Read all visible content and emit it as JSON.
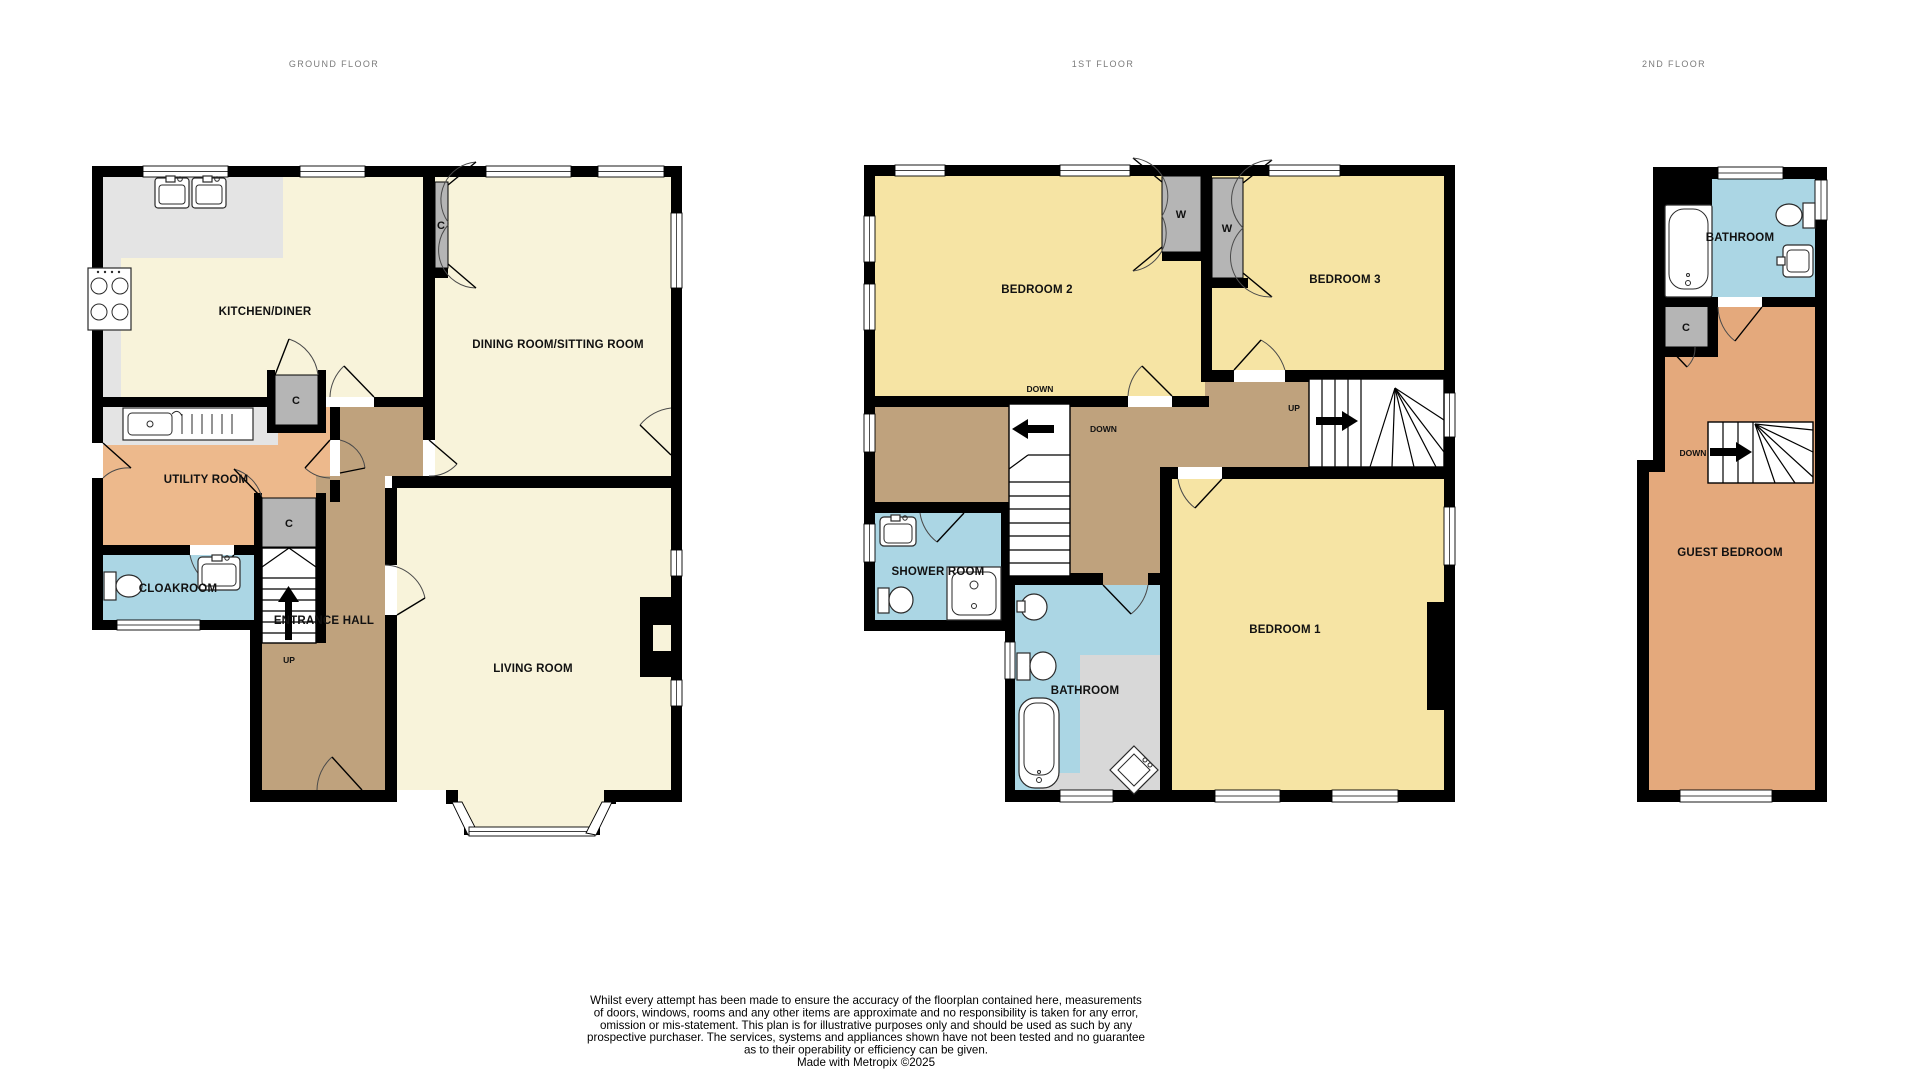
{
  "floors": {
    "ground": {
      "title": "GROUND FLOOR"
    },
    "first": {
      "title": "1ST FLOOR"
    },
    "second": {
      "title": "2ND FLOOR"
    }
  },
  "rooms": {
    "kitchen": "KITCHEN/DINER",
    "dining": "DINING ROOM/SITTING ROOM",
    "utility": "UTILITY ROOM",
    "cloakroom": "CLOAKROOM",
    "hall": "ENTRANCE HALL",
    "living": "LIVING ROOM",
    "bed1": "BEDROOM 1",
    "bed2": "BEDROOM 2",
    "bed3": "BEDROOM 3",
    "shower": "SHOWER ROOM",
    "bathroom_first": "BATHROOM",
    "bathroom_second": "BATHROOM",
    "guest": "GUEST BEDROOM"
  },
  "markers": {
    "cupboard": "C",
    "wardrobe": "W",
    "up": "UP",
    "down": "DOWN"
  },
  "disclaimer": {
    "lines": [
      "Whilst every attempt has been made to ensure the accuracy of the floorplan contained here, measurements",
      "of doors, windows, rooms and any other items are approximate and no responsibility is taken for any error,",
      "omission or mis-statement. This plan is for illustrative purposes only and should be used as such by any",
      "prospective purchaser. The services, systems and appliances shown have not been tested and no guarantee",
      "as to their operability or efficiency can be given.",
      "Made with Metropix ©2025"
    ]
  },
  "colors": {
    "wall": "#000000",
    "reception_floor": "#f8f3da",
    "bedroom_floor": "#f6e4a4",
    "hall_floor": "#bfa27d",
    "utility_floor": "#edb98c",
    "guest_floor": "#e4a97c",
    "wet_room_floor": "#abd6e4",
    "counter": "#e4e4e4",
    "cupboard": "#b5b5b5",
    "shading": "#d8d8d8",
    "title_text": "#7b7b7b"
  }
}
